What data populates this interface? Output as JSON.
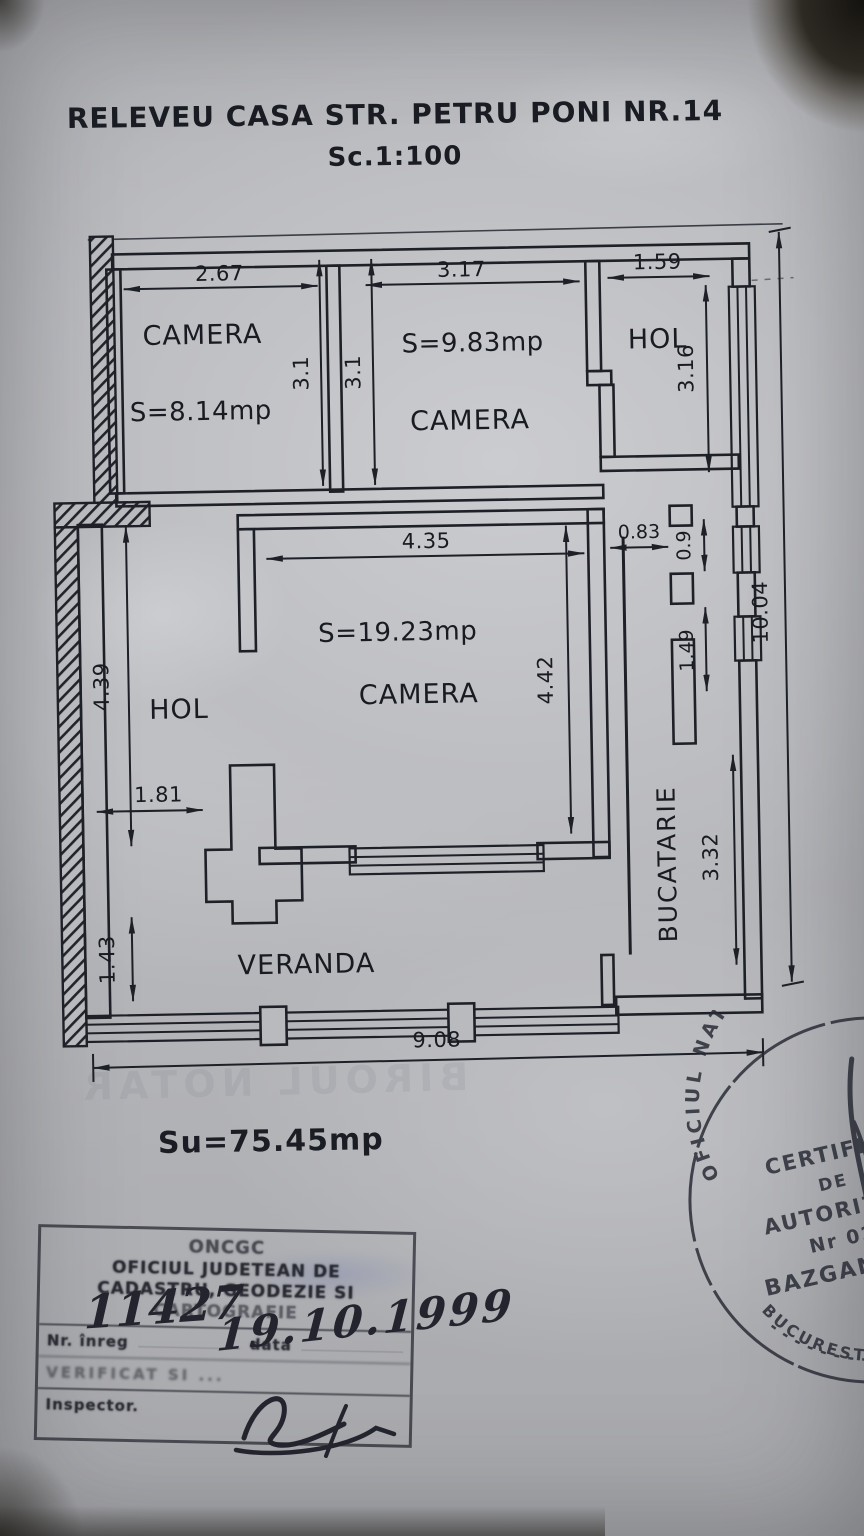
{
  "document": {
    "title": "RELEVEU CASA STR. PETRU PONI NR.14",
    "scale_label": "Sc.1:100",
    "total_area": "Su=75.45mp"
  },
  "plan": {
    "rooms": {
      "camera1": {
        "name": "CAMERA",
        "area": "S=8.14mp"
      },
      "camera2": {
        "name": "CAMERA",
        "area": "S=9.83mp"
      },
      "hol_top": {
        "name": "HOL"
      },
      "camera3": {
        "name": "CAMERA",
        "area": "S=19.23mp"
      },
      "hol_mid": {
        "name": "HOL"
      },
      "veranda": {
        "name": "VERANDA"
      },
      "bucatarie": {
        "name": "BUCATARIE"
      }
    },
    "dims": {
      "w_camera1": "2.67",
      "w_camera2": "3.17",
      "w_hol_top": "1.59",
      "h_camera1": "3.1",
      "h_camera2": "3.1",
      "h_hol_top": "3.16",
      "w_camera3": "4.35",
      "h_camera3": "4.42",
      "nook_w": "0.83",
      "nook_h1": "0.9",
      "nook_h2": "1.49",
      "h_hol_mid": "4.39",
      "w_hol_mid": "1.81",
      "h_veranda_left": "1.43",
      "h_bucatarie": "3.32",
      "total_height": "10.04",
      "total_width": "9.08"
    }
  },
  "stamps": {
    "rect": {
      "line1": "ONCGC",
      "line2": "OFICIUL JUDETEAN DE",
      "line3": "CADASTRU, GEODEZIE SI",
      "line4": "CARTOGRAFIE",
      "nr_label": "Nr. înreg",
      "data_label": "data",
      "nr_value": "11427",
      "data_value": "19.10.1999",
      "line5": "VERIFICAT SI ...",
      "line6": "Inspector."
    },
    "round": {
      "arc_top": "OFICIUL NATIONAL DE CADASTRU",
      "arc_bottom": "BUCURESTI - ROMANIA",
      "center1": "CERTIFICAT",
      "center2": "DE",
      "center3": "AUTORIZARE",
      "center4": "Nr 0272",
      "center5": "BAZGAN IOAN"
    }
  },
  "ghost_text": "BIROUL NOTAR"
}
